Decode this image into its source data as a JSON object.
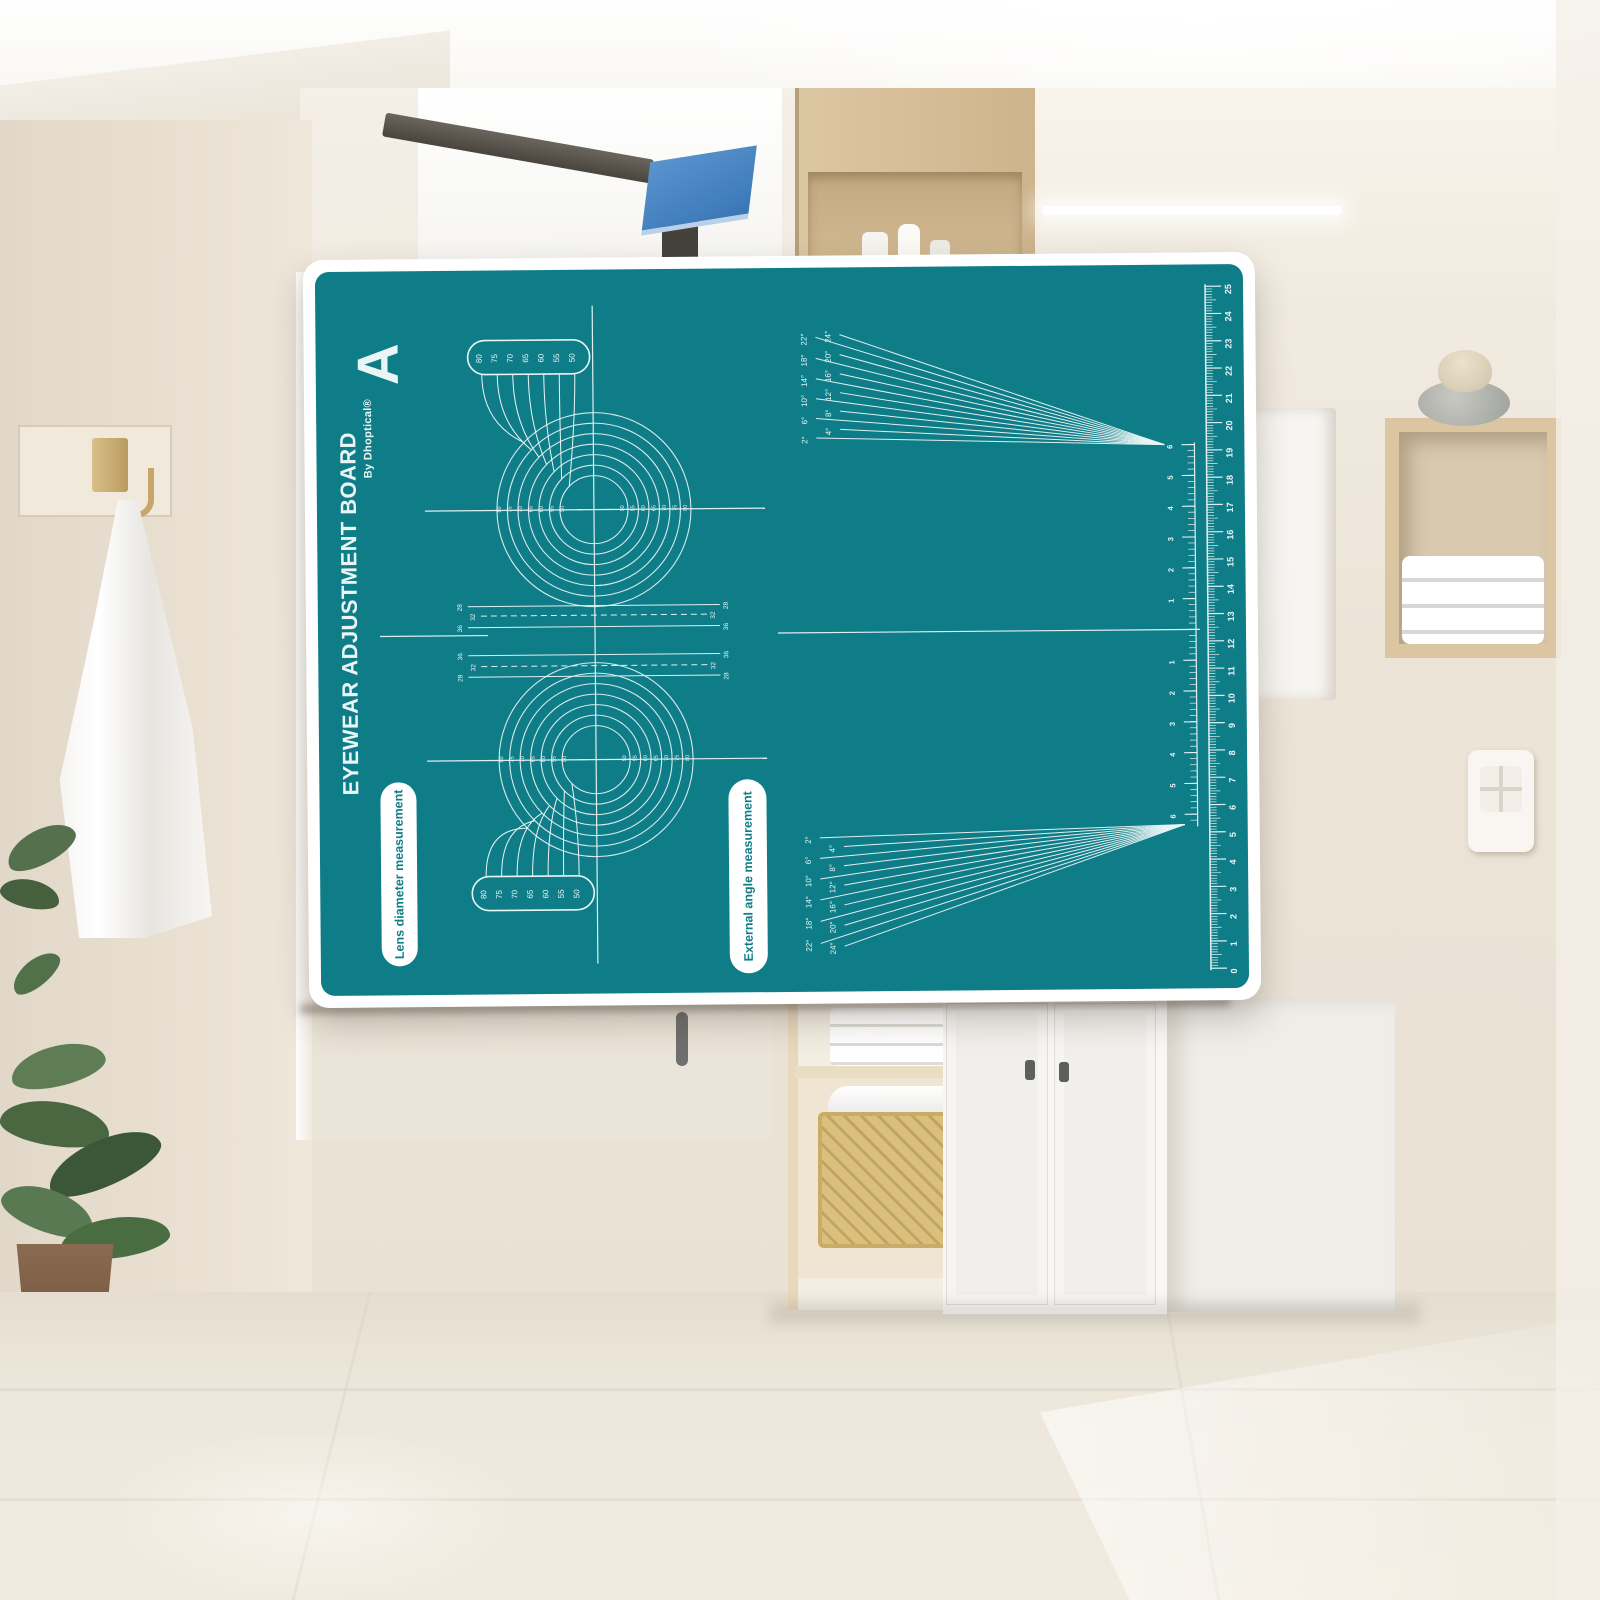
{
  "product": {
    "title": "EYEWEAR ADJUSTMENT BOARD",
    "byline": "By Dhoptical®",
    "corner_letter": "A",
    "lens_pill_label": "Lens diameter measurement",
    "angle_pill_label": "External angle measurement",
    "lens_diameters": [
      "80",
      "75",
      "70",
      "65",
      "60",
      "55",
      "50"
    ],
    "bridge_labels_outer": [
      "28",
      "36"
    ],
    "bridge_label_inner": "32",
    "fan_angles": [
      "2°",
      "4°",
      "6°",
      "8°",
      "10°",
      "12°",
      "14°",
      "16°",
      "18°",
      "20°",
      "22°",
      "24°"
    ],
    "inner_scale": [
      "1",
      "2",
      "3",
      "4",
      "5",
      "6"
    ],
    "ruler_numbers": [
      "0",
      "1",
      "2",
      "3",
      "4",
      "5",
      "6",
      "7",
      "8",
      "9",
      "10",
      "11",
      "12",
      "13",
      "14",
      "15",
      "16",
      "17",
      "18",
      "19",
      "20",
      "21",
      "22",
      "23",
      "24",
      "25"
    ]
  },
  "colors": {
    "board_teal": "#0f7d87",
    "ink": "#eaf6f6",
    "backing_white": "#ffffff",
    "pill_bg": "#ffffff",
    "flag_blue": "#4183c4",
    "wall_beige": "#ece4d7",
    "wood_tan": "#d9c29c",
    "floor_beige": "#ede7db",
    "basket_wicker": "#d8bf7e",
    "plant_green": "#53704b",
    "pot_brown": "#7e6049"
  }
}
